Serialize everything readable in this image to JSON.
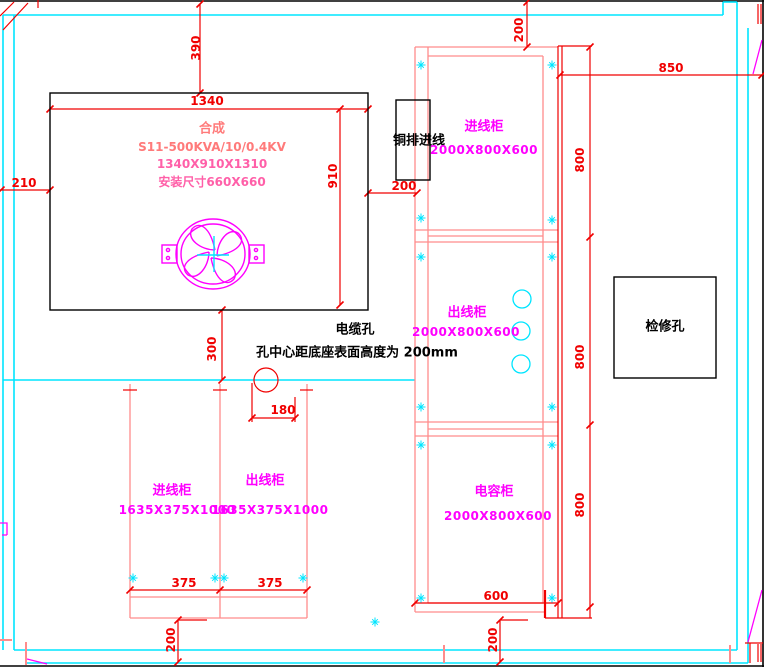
{
  "colors": {
    "wall": "#00ffff",
    "cabinet_outline": "#ff8c8c",
    "dimension": "#f00000",
    "label": "#ff00ff",
    "annotation": "#000000",
    "fan": "#ff00ff"
  },
  "transformer": {
    "title": "合成",
    "model": "S11-500KVA/10/0.4KV",
    "size": "1340X910X1310",
    "install": "安装尺寸660X660",
    "width_dim": "1340",
    "depth_dim": "910"
  },
  "clearances": {
    "top": "390",
    "left": "210",
    "right": "200",
    "below": "300",
    "cable_hole_offset": "180"
  },
  "cable_note": {
    "title": "电缆孔",
    "detail": "孔中心距底座表面高度为 200mm"
  },
  "busbar": {
    "label": "铜排进线"
  },
  "inspection": {
    "label": "检修孔"
  },
  "switchgear": {
    "top_gap": "200",
    "right_span": "850",
    "width_dim": "600",
    "bottom_gap": "200",
    "cabinets": [
      {
        "label": "进线柜",
        "size": "2000X800X600",
        "depth": "800"
      },
      {
        "label": "出线柜",
        "size": "2000X800X600",
        "depth": "800"
      },
      {
        "label": "电容柜",
        "size": "2000X800X600",
        "depth": "800"
      }
    ]
  },
  "lv_cabinets": {
    "bottom_gap": "200",
    "items": [
      {
        "label": "进线柜",
        "size": "1635X375X1000",
        "width": "375"
      },
      {
        "label": "出线柜",
        "size": "1635X375X1000",
        "width": "375"
      }
    ]
  }
}
